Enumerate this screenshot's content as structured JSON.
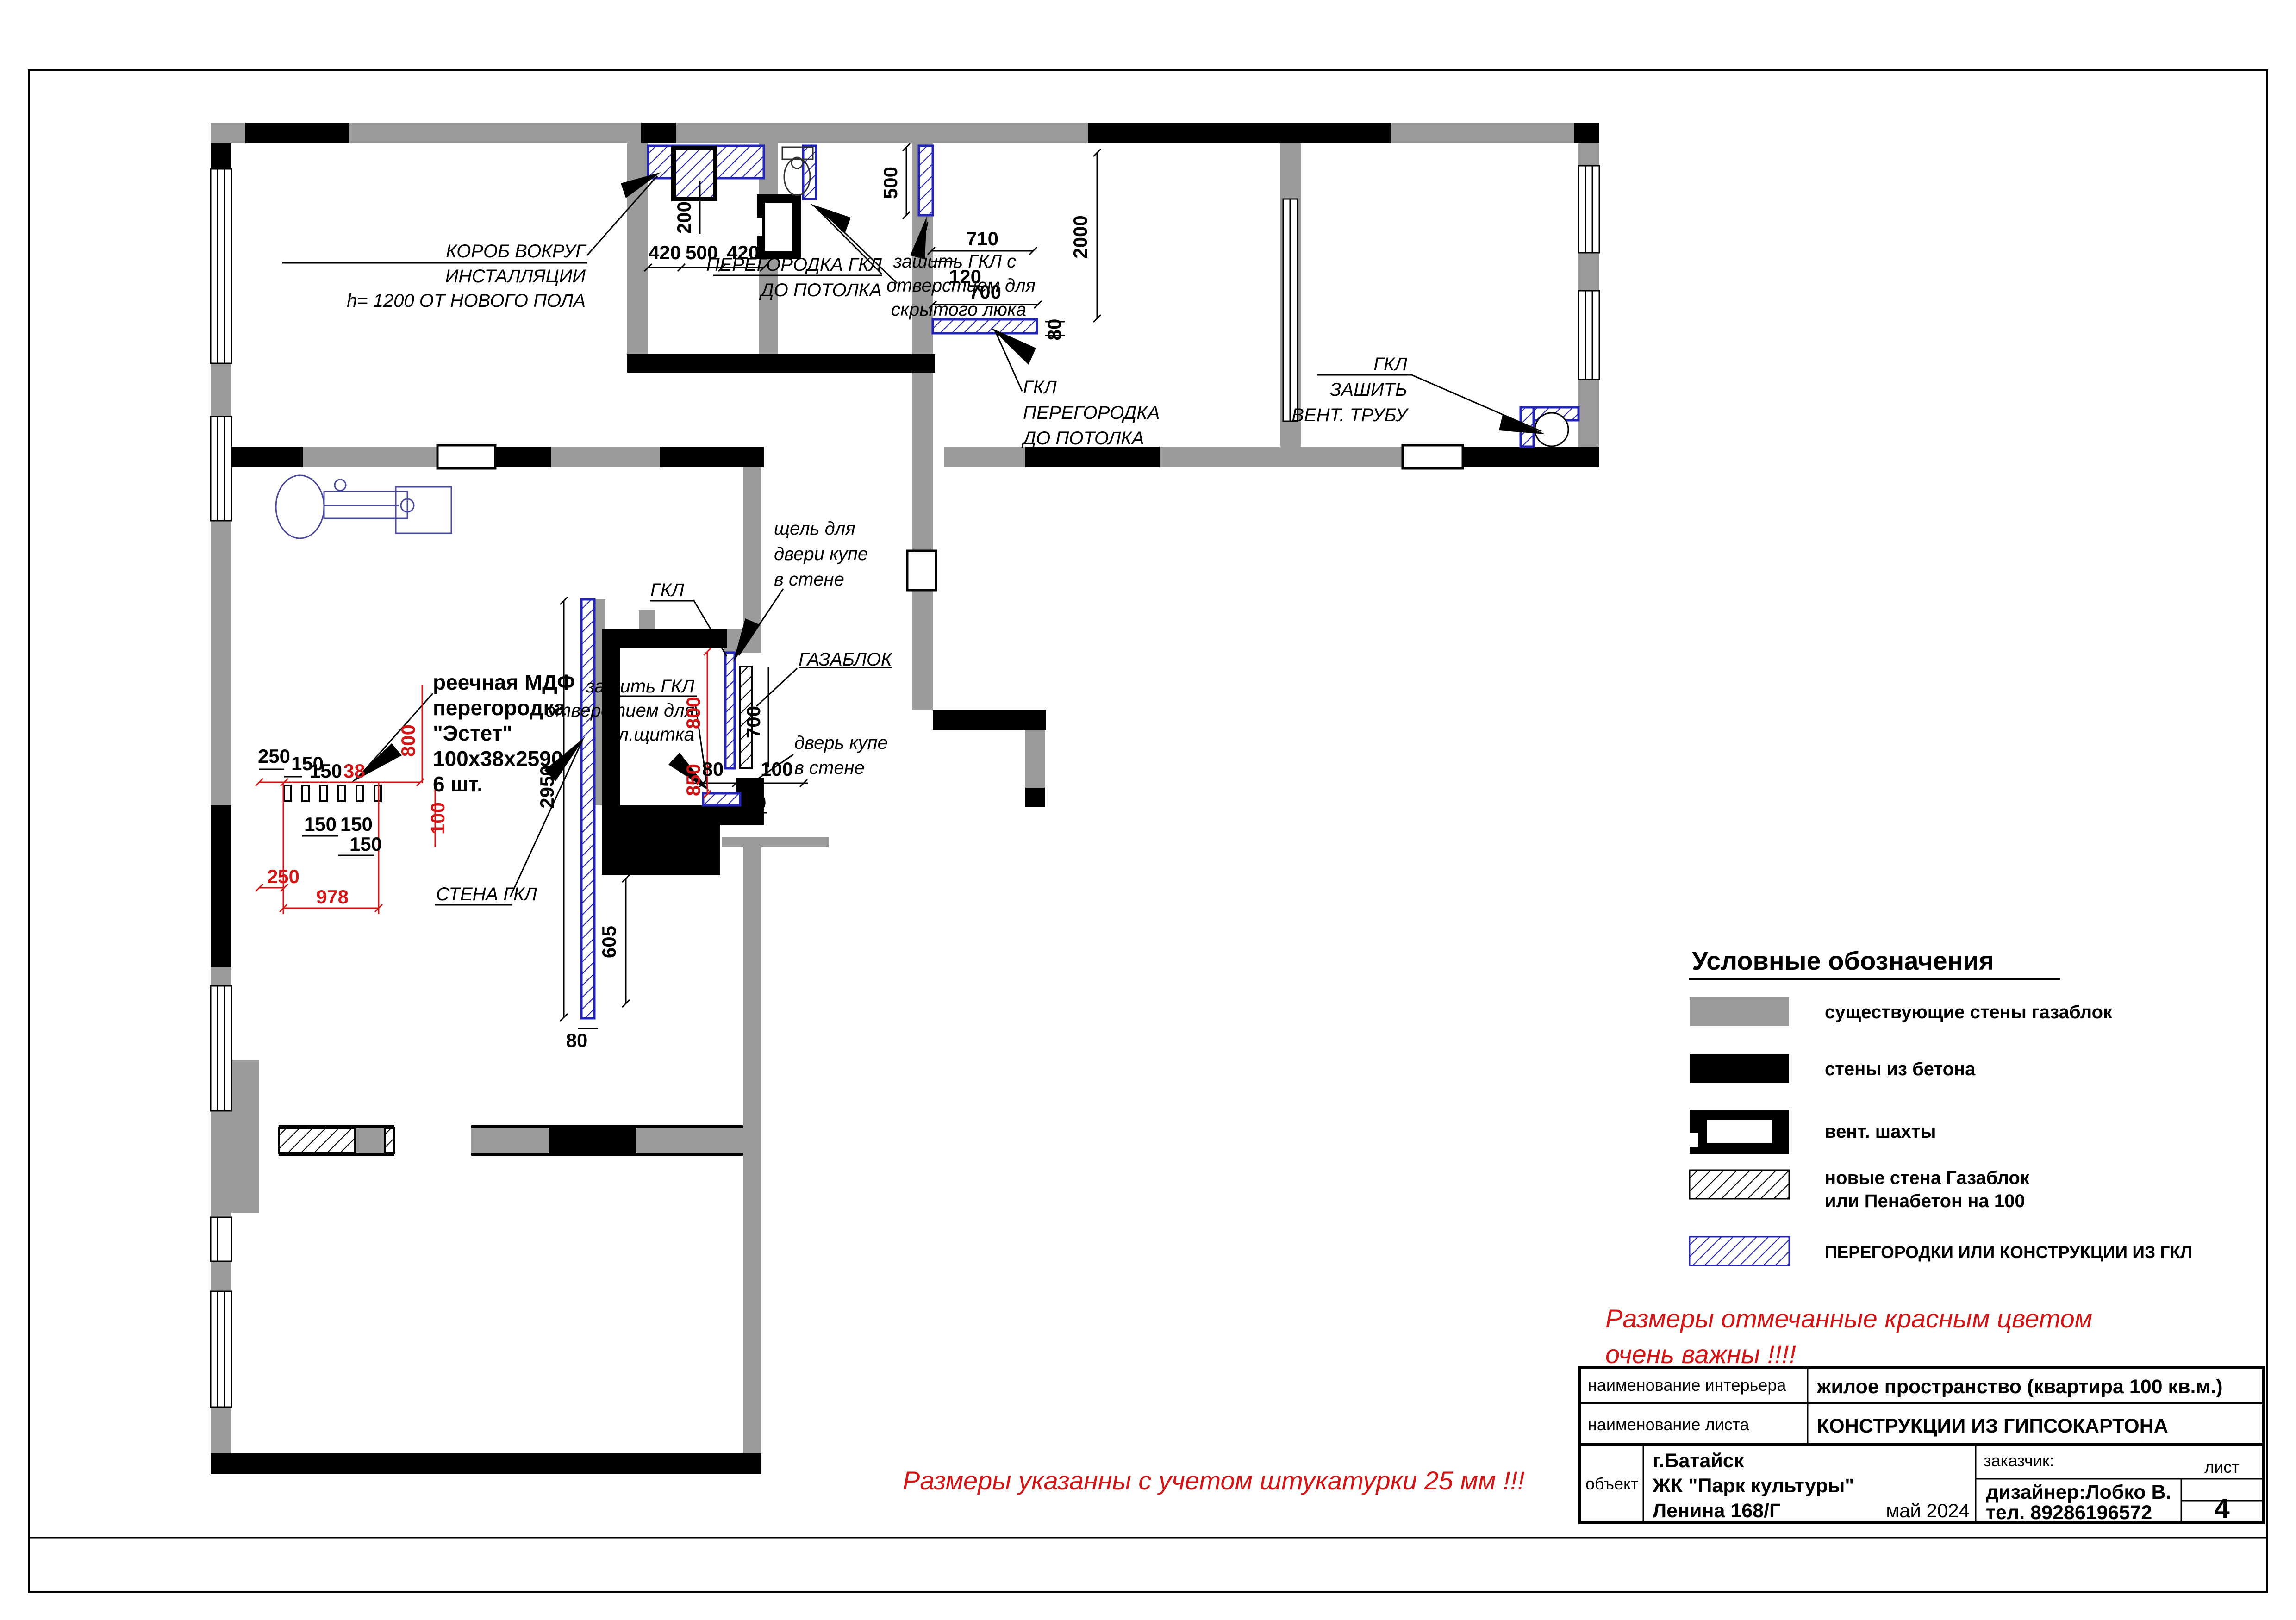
{
  "plan": {
    "callouts": {
      "korob1": "КОРОБ ВОКРУГ",
      "korob2": "ИНСТАЛЛЯЦИИ",
      "korob3": "h= 1200 ОТ НОВОГО ПОЛА",
      "wcpart1": "ПЕРЕГОРОДКА ГКЛ",
      "wcpart2": "ДО ПОТОЛКА",
      "lyuk1": "зашить ГКЛ с",
      "lyuk2": "отверстием для",
      "lyuk3": "скрытого люка",
      "stub1": "ГКЛ",
      "stub2": "ПЕРЕГОРОДКА",
      "stub3": "ДО ПОТОЛКА",
      "vent1": "ГКЛ",
      "vent2": "ЗАШИТЬ",
      "vent3": "ВЕНТ. ТРУБУ",
      "slot1": "щель для",
      "slot2": "двери купе",
      "slot3": "в стене",
      "gkl": "ГКЛ",
      "gazablok": "ГАЗАБЛОК",
      "door1": "дверь купе",
      "door2": "в стене",
      "panel1": "зашить ГКЛ",
      "panel2": "отверстием для",
      "panel3": "эл.щитка",
      "mdf1": "реечная МДФ",
      "mdf2": "перегородка",
      "mdf3": "\"Эстет\"",
      "mdf4": "100x38x2590",
      "mdf_qty": "6 шт.",
      "stena": "СТЕНА ГКЛ"
    },
    "dims": {
      "d38": "38",
      "d50": "50",
      "d80": "80",
      "d100": "100",
      "d120": "120",
      "d150": "150",
      "d200": "200",
      "d250": "250",
      "d420": "420",
      "d500": "500",
      "d605": "605",
      "d700": "700",
      "d710": "710",
      "d800": "800",
      "d850": "850",
      "d978": "978",
      "d2000": "2000",
      "d2950": "2950"
    }
  },
  "legend": {
    "title": "Условные обозначения",
    "items": [
      {
        "label": "существующие стены газаблок"
      },
      {
        "label": "стены из бетона"
      },
      {
        "label": "вент. шахты"
      },
      {
        "label": "новые стена Газаблок",
        "label2": "или Пенабетон на 100"
      },
      {
        "label": "ПЕРЕГОРОДКИ ИЛИ КОНСТРУКЦИИ ИЗ ГКЛ"
      }
    ]
  },
  "notes": {
    "red1a": "Размеры отмечанные красным цветом",
    "red1b": "очень важны !!!!",
    "red2": "Размеры указанны  с учетом штукатурки 25 мм !!!"
  },
  "titleblock": {
    "row1_label": "наименование интерьера",
    "row1_value": "жилое пространство (квартира 100 кв.м.)",
    "row2_label": "наименование листа",
    "row2_value": "КОНСТРУКЦИИ ИЗ ГИПСОКАРТОНА",
    "object_label": "объект",
    "object1": "г.Батайск",
    "object2": "ЖК \"Парк культуры\"",
    "object3": "Ленина 168/Г",
    "date": "май 2024",
    "customer_label": "заказчик:",
    "designer": "дизайнер:Лобко В.",
    "phone": "тел. 89286196572",
    "sheet_label": "лист",
    "sheet_number": "4"
  },
  "colors": {
    "wall_gray": "#9a9a9a",
    "wall_black": "#000000",
    "gkl_blue": "#2323b4",
    "red": "#d01616"
  }
}
